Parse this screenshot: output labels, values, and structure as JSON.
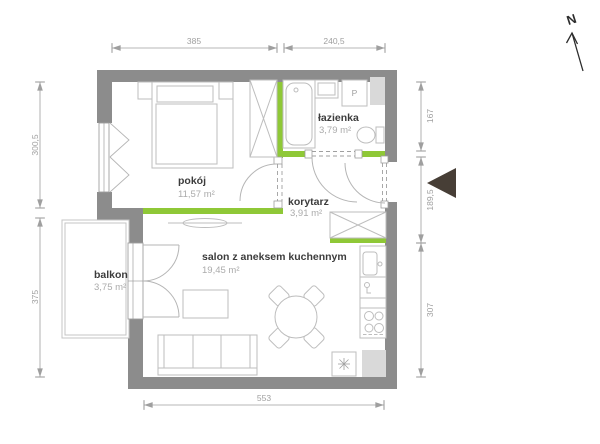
{
  "floorplan": {
    "rooms": {
      "pokoj": {
        "name": "pokój",
        "area": "11,57 m²"
      },
      "lazienka": {
        "name": "łazienka",
        "area": "3,79 m²"
      },
      "korytarz": {
        "name": "korytarz",
        "area": "3,91 m²"
      },
      "salon": {
        "name": "salon z aneksem kuchennym",
        "area": "19,45 m²"
      },
      "balkon": {
        "name": "balkon",
        "area": "3,75 m²"
      }
    },
    "dimensions_cm": {
      "top_left": "385",
      "top_right": "240,5",
      "left_upper": "300,5",
      "left_lower": "375",
      "right_upper": "167",
      "right_middle": "189,5",
      "right_lower": "307",
      "bottom": "553"
    },
    "compass": {
      "label": "N"
    },
    "appliance_labels": {
      "washing_machine": "P"
    },
    "colors": {
      "wall_gray": "#8c8c8c",
      "accent_green": "#8fc837",
      "entrance_marker_brown": "#473e36",
      "furniture_line_gray": "#bdbdbd",
      "dimension_gray": "#9f9f9f",
      "shaft_fill_gray": "#d9d9d9",
      "room_label_dark": "#3c3c3c",
      "area_label_gray": "#ababab"
    }
  }
}
